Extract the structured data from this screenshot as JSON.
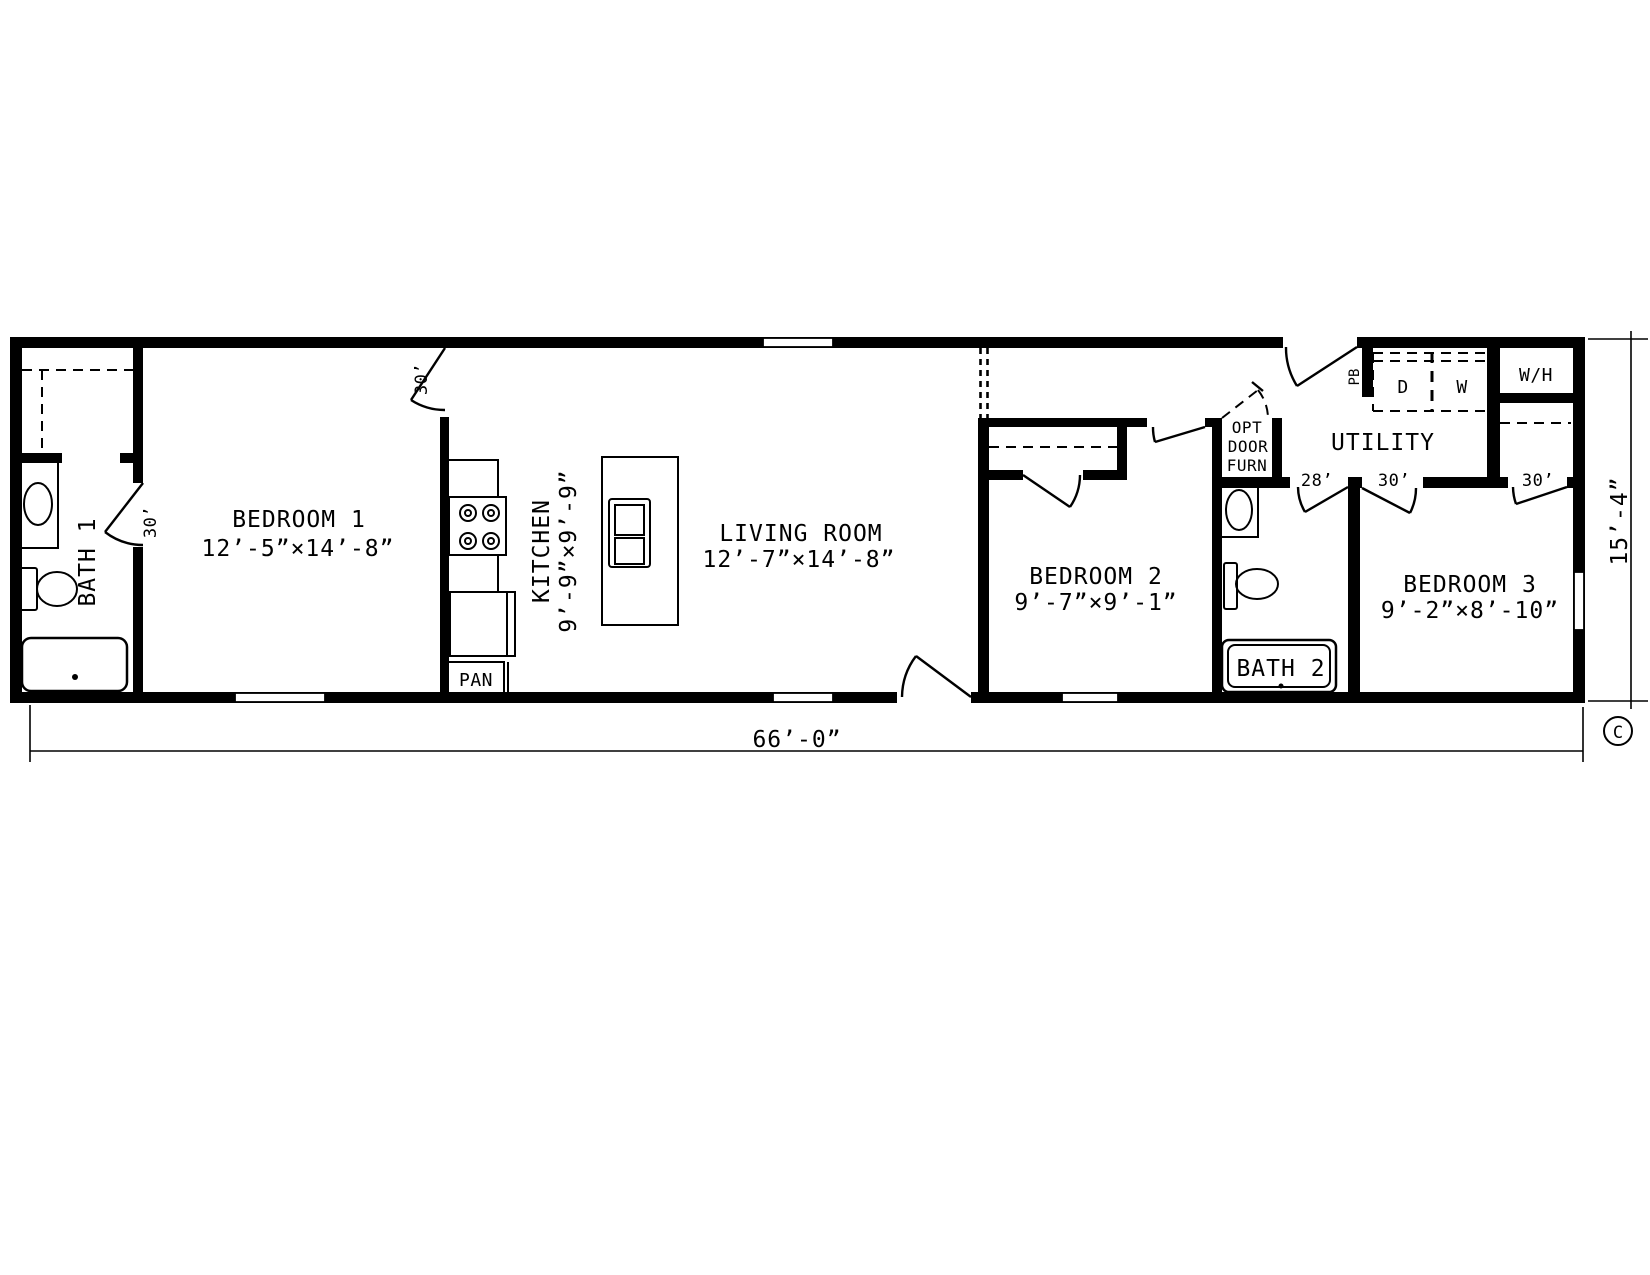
{
  "plan": {
    "rooms": {
      "bath1": {
        "name": "BATH 1"
      },
      "bedroom1": {
        "name": "BEDROOM 1",
        "dims": "12’-5”×14’-8”"
      },
      "kitchen": {
        "name": "KITCHEN",
        "dims": "9’-9”×9’-9”"
      },
      "living": {
        "name": "LIVING ROOM",
        "dims": "12’-7”×14’-8”"
      },
      "bedroom2": {
        "name": "BEDROOM 2",
        "dims": "9’-7”×9’-1”"
      },
      "bath2": {
        "name": "BATH 2"
      },
      "bedroom3": {
        "name": "BEDROOM 3",
        "dims": "9’-2”×8’-10”"
      },
      "utility": {
        "name": "UTILITY"
      }
    },
    "labels": {
      "pantry": "PAN",
      "dryer": "D",
      "washer": "W",
      "water_heater": "W/H",
      "panel_box": "PB",
      "opt_furn_line1": "OPT",
      "opt_furn_line2": "DOOR",
      "opt_furn_line3": "FURN"
    },
    "doors": {
      "bath1_door": "30’",
      "bedroom1_door": "30’",
      "bath2_door": "28’",
      "bedroom3_door": "30’",
      "bedroom3_closet_door": "30’"
    },
    "dimensions": {
      "overall_width": "66’-0”",
      "overall_height": "15’-4”"
    },
    "copyright_mark": "C"
  }
}
